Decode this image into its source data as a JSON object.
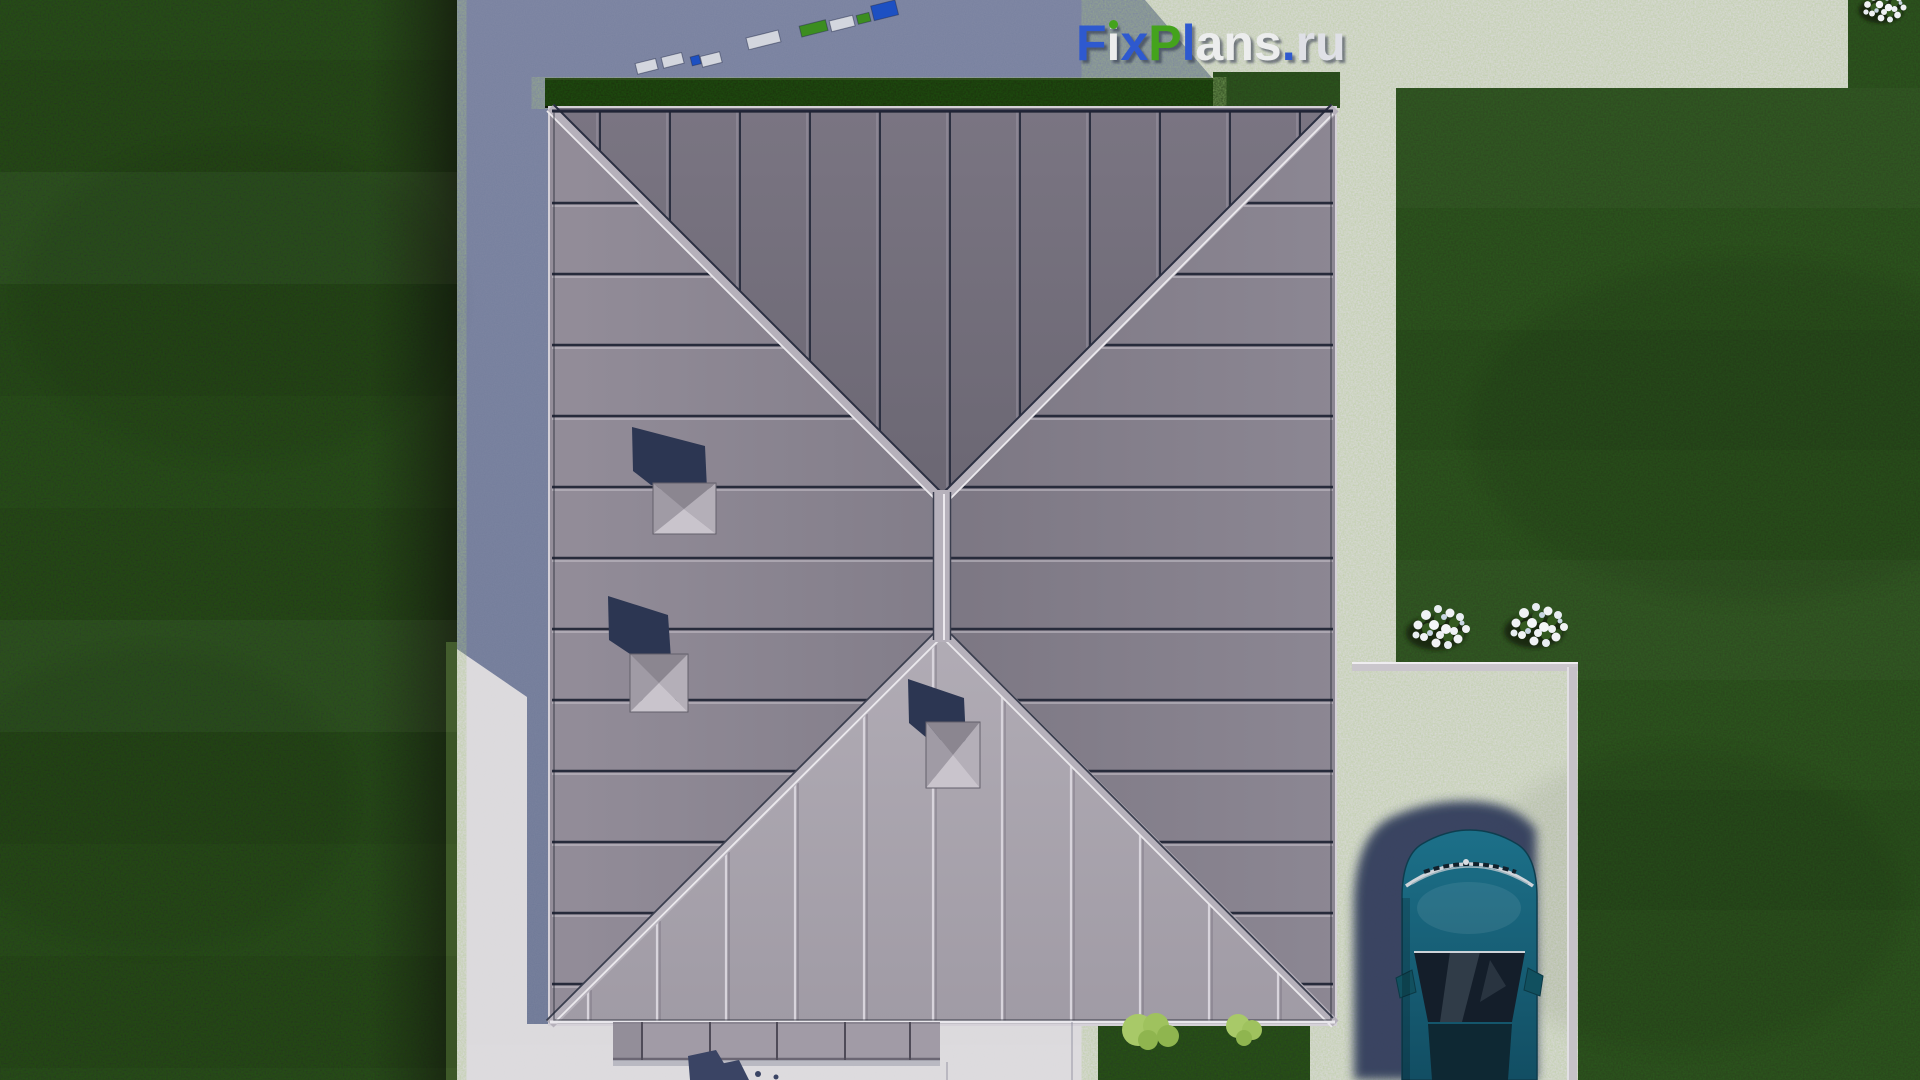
{
  "watermark": {
    "text": "FixPlans.ru",
    "letters": [
      "F",
      "i",
      "x",
      "P",
      "l",
      "a",
      "n",
      "s",
      ".",
      "r",
      "u"
    ]
  },
  "palette": {
    "logo_blue": "#2E59CF",
    "logo_green": "#44A31C",
    "logo_white": "#ECEDED",
    "grass_dark": "#26361C",
    "grass_field": "#2C3F20",
    "hedge_green": "#1D2C12",
    "pavement_sunlit": "#DCDADD",
    "pavement_shadow": "#78819F",
    "roof_north": "#6F6B77",
    "roof_west": "#8F8995",
    "roof_east": "#857F8C",
    "roof_south": "#A9A4AE",
    "roof_ridge_light": "#B6B1BB",
    "roof_seam_dark": "#272B3B",
    "chimney_shadow_navy": "#2C3652",
    "car_teal": "#16607C",
    "car_glass": "#141E2A",
    "car_shadow_navy": "#333D5B",
    "flower_white": "#F0F2F5",
    "shrub_green": "#A8C968"
  },
  "scene": {
    "objects": [
      "hip-roof",
      "roof-chimney",
      "hedge",
      "lawn",
      "paved-yard",
      "stepping-stones",
      "driveway",
      "parked-car",
      "flower-bush",
      "shrub"
    ]
  }
}
